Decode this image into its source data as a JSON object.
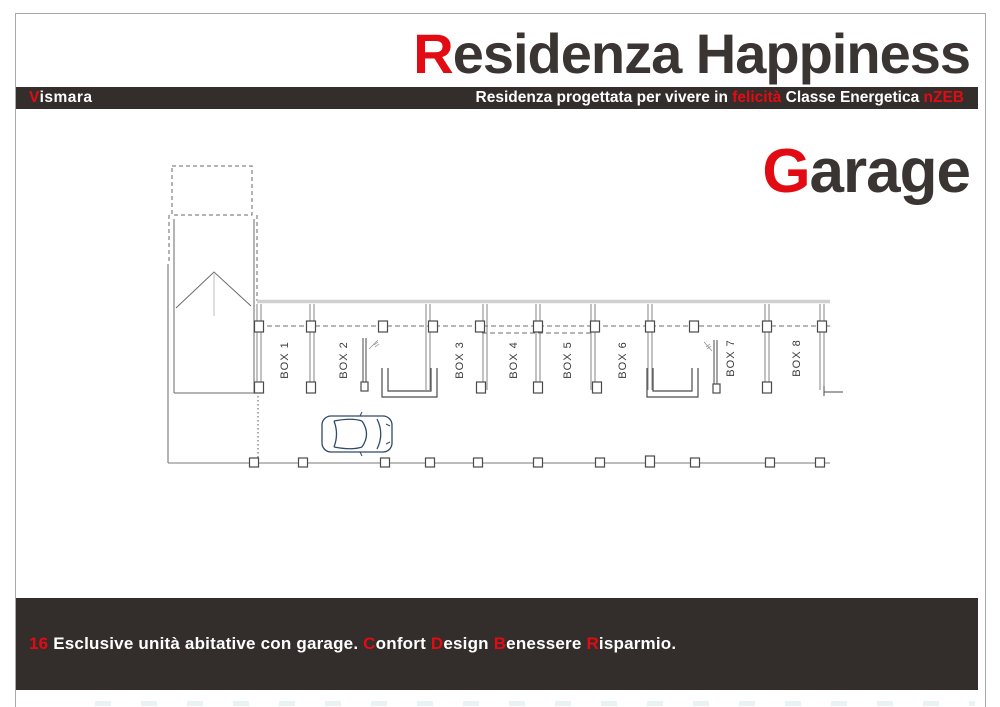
{
  "header": {
    "title": {
      "accent": "R",
      "rest": "esidenza Happiness"
    },
    "band": {
      "logo": {
        "accent": "V",
        "rest": "ismara"
      },
      "tagline": [
        {
          "text": "Residenza progettata per vivere in "
        },
        {
          "text": "felicità"
        },
        {
          "text": " Classe Energetica "
        },
        {
          "text": "nZEB"
        }
      ]
    }
  },
  "section": {
    "title": {
      "accent": "G",
      "rest": "arage"
    }
  },
  "plan": {
    "boxes": [
      "BOX 1",
      "BOX 2",
      "BOX 3",
      "BOX 4",
      "BOX 5",
      "BOX 6",
      "BOX 7",
      "BOX 8"
    ]
  },
  "footer": {
    "segments": [
      {
        "text": "16"
      },
      {
        "text": " Esclusive unità abitative con garage. "
      },
      {
        "text": "C"
      },
      {
        "text": "onfort "
      },
      {
        "text": "D"
      },
      {
        "text": "esign "
      },
      {
        "text": "B"
      },
      {
        "text": "enessere "
      },
      {
        "text": "R"
      },
      {
        "text": "isparmio."
      }
    ]
  },
  "colors": {
    "accent_red": "#e30b13",
    "band_background": "#332d2b",
    "ink": "#3a3532",
    "plan_line": "#808080",
    "car_line": "#2e4a68"
  }
}
